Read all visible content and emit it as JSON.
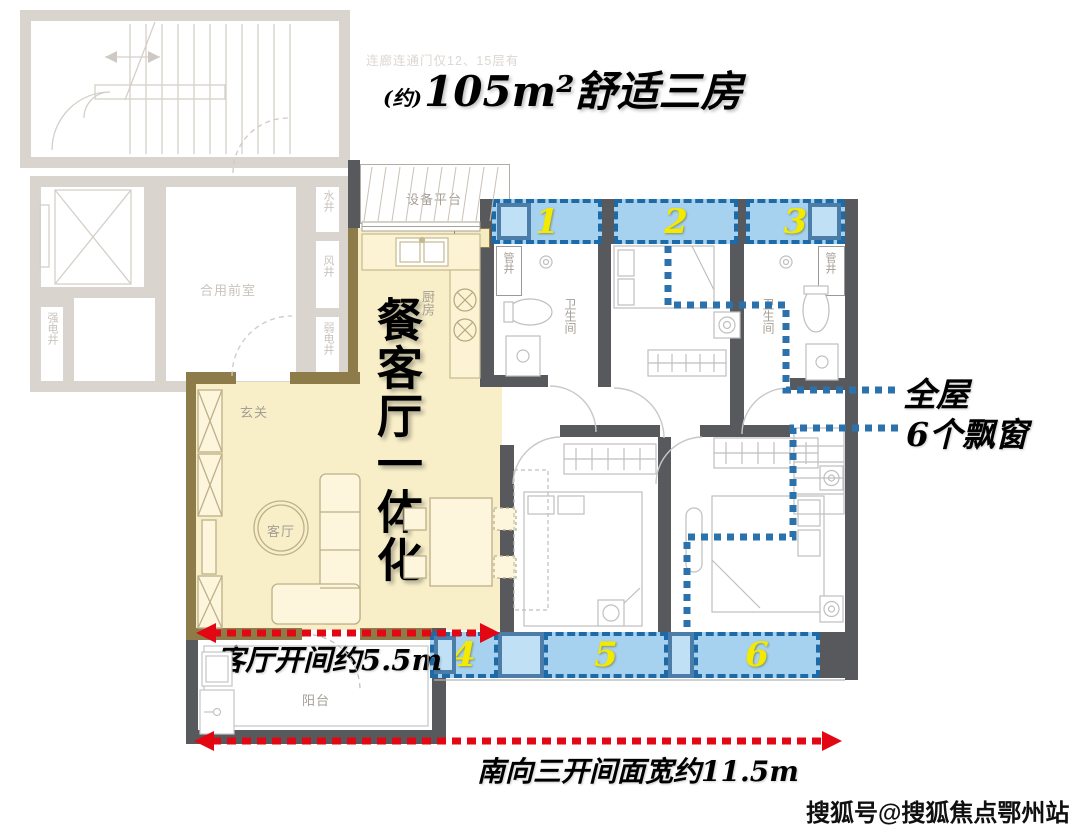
{
  "title": {
    "prefix": "(约)",
    "main": "105m²舒适三房"
  },
  "corridor_note": "连廊连通门仅12、15层有",
  "core": {
    "lobby": "合用前室",
    "strong_shaft": "强电井",
    "water_shaft": "水井",
    "wind_shaft": "风井",
    "weak_shaft": "弱电井"
  },
  "rooms": {
    "equipment_platform": "设备平台",
    "kitchen": "厨房",
    "flue": "烟道",
    "hallway": "玄关",
    "living": "客厅",
    "dining": "餐厅",
    "balcony": "阳台",
    "bedroom_top": "卧室",
    "bedroom_left": "卧室",
    "master": "主卧",
    "bath1": "卫生间",
    "bath2": "卫生间",
    "pipe_shaft_1": "管井",
    "pipe_shaft_2": "管井"
  },
  "bay_windows": {
    "numbers": [
      "1",
      "2",
      "3",
      "4",
      "5",
      "6"
    ],
    "fill_color": "#a7d2ef",
    "border_color": "#1e6aa6",
    "number_color": "#f3ea00"
  },
  "annotations": {
    "banner_vertical": "餐客厅一体化",
    "whole_house_line1": "全屋",
    "whole_house_line2": "6个飘窗",
    "living_width": "客厅开间约5.5m",
    "south_width": "南向三开间面宽约11.5m",
    "arrow_color": "#e30613",
    "connector_color": "#2b72ad"
  },
  "watermark": "搜狐号@搜狐焦点鄂州站",
  "colors": {
    "highlight_yellow": "#f8efc9",
    "wall_dark": "#58595c",
    "wall_olive": "#8d7c49",
    "core_faded": "#dad4cf"
  }
}
